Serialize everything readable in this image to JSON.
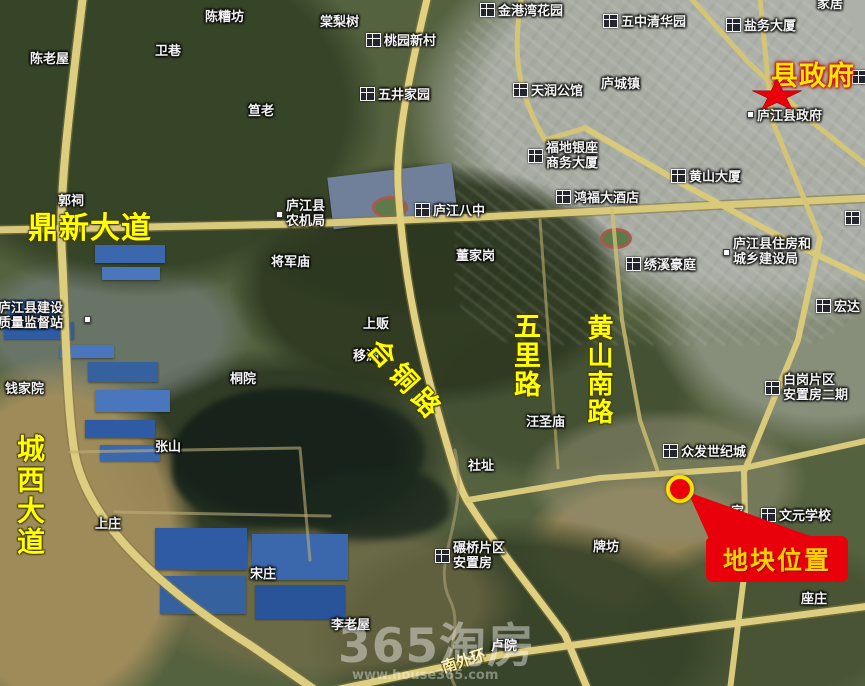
{
  "road_labels": {
    "dingxin_avenue": "鼎新大道",
    "chengxi_avenue": "城西大道",
    "hetong_road": "合铜路",
    "wuli_road": "五里路",
    "huangshan_south_road": "黄山南路",
    "south_outer_ring": "南外环"
  },
  "markers": {
    "county_government": "县政府",
    "plot_location": "地块位置"
  },
  "places": {
    "chen_laowu": "陈老屋",
    "wei_xiang": "卫巷",
    "chen_zaofang": "陈糟坊",
    "da_lao": "笪老",
    "tang_lishu": "棠梨树",
    "taoyuan_xincun": "桃园新村",
    "jingangwan_huayuan": "金港湾花园",
    "wujing_jiayuan": "五井家园",
    "wuzhong_qinghuayuan": "五中清华园",
    "yanwu_dasha": "盐务大厦",
    "corner_partial": "家居",
    "tianrun_gongguan": "天润公馆",
    "lucheng_zhen": "庐城镇",
    "lujiang_county_gov": "庐江县政府",
    "fudi_yinzuo_line1": "福地银座",
    "fudi_yinzuo_line2": "商务大厦",
    "huangshan_dasha": "黄山大厦",
    "hongfu_hotel": "鸿福大酒店",
    "lujiang_bazhong": "庐江八中",
    "nongjiju_line1": "庐江县",
    "nongjiju_line2": "农机局",
    "guo_ci": "郭祠",
    "jiangjun_miao": "将军庙",
    "dongjia_gang": "董家岗",
    "xiuxi_haoting": "绣溪豪庭",
    "zhufang_line1": "庐江县住房和",
    "zhufang_line2": "城乡建设局",
    "hongda": "宏达",
    "shang_fan": "上贩",
    "yi_hu": "移湖",
    "tong_yuan": "桐院",
    "qianjia_yuan": "钱家院",
    "jianshe_line1": "庐江县建设",
    "jianshe_line2": "质量监督站",
    "zhang_shan": "张山",
    "shang_zhuang": "上庄",
    "song_zhuang": "宋庄",
    "wangsheng_miao": "汪圣庙",
    "she_zhi": "社址",
    "zhongfa_shijicheng": "众发世纪城",
    "baigang_line1": "白岗片区",
    "baigang_line2": "安置房二期",
    "wenyuan_school": "文元学校",
    "pai_fang": "牌坊",
    "nianqiao_line1": "碾桥片区",
    "nianqiao_line2": "安置房",
    "li_laowu": "李老屋",
    "lu_yuan": "卢院",
    "zuo_zhuang": "座庄",
    "partial_jia": "家"
  },
  "watermark": {
    "brand": "365淘房",
    "url": "www.house365.com"
  },
  "colors": {
    "road_label_yellow": "#ffff00",
    "place_label_white": "#f4f4f4",
    "accent_red": "#e8000b",
    "marker_ring_yellow": "#ffe100",
    "callout_text": "#ffd000",
    "road_fill": "#d9c97a"
  }
}
